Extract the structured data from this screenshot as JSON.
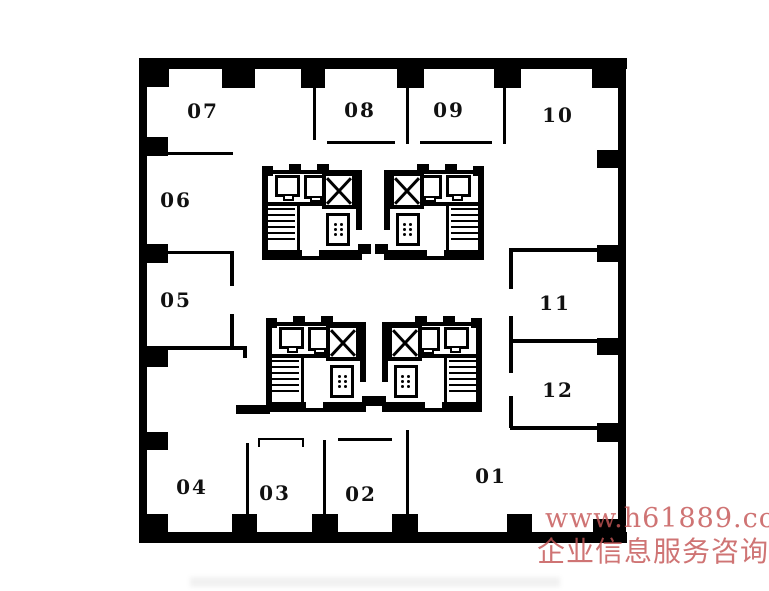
{
  "plan": {
    "type": "office-floor-plan",
    "rooms": {
      "r01": "01",
      "r02": "02",
      "r03": "03",
      "r04": "04",
      "r05": "05",
      "r06": "06",
      "r07": "07",
      "r08": "08",
      "r09": "09",
      "r10": "10",
      "r11": "11",
      "r12": "12"
    },
    "core_elements": [
      "elevator-shaft",
      "elevator-car",
      "stairs",
      "toilet-fixtures"
    ],
    "colors": {
      "wall": "#000000",
      "background": "#ffffff",
      "watermark": "#c55555"
    }
  },
  "watermark": {
    "line1": "www.h61889.com",
    "line2": "企业信息服务咨询"
  }
}
